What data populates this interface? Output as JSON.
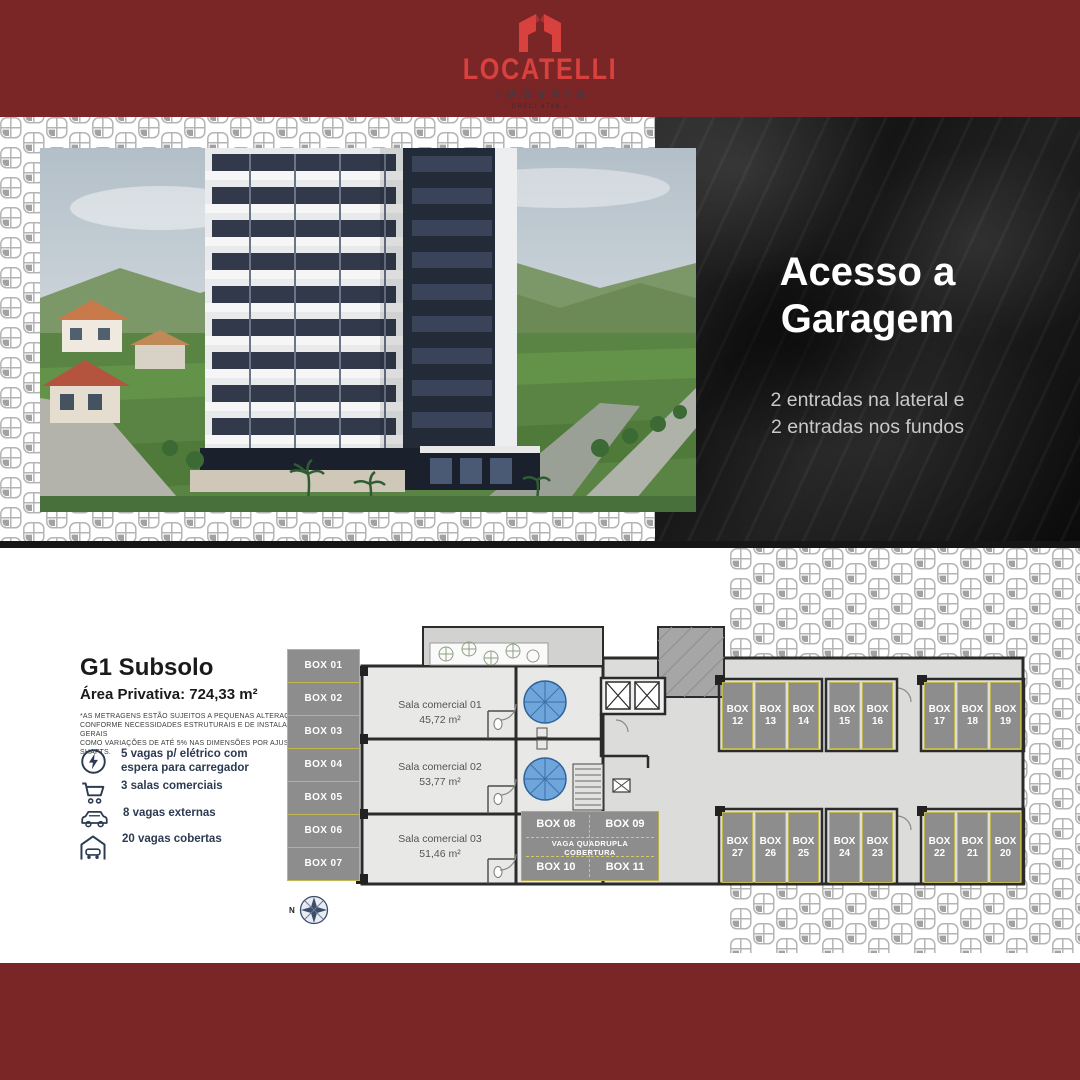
{
  "brand": {
    "name": "LOCATELLI",
    "subtitle": "IMÓVEIS",
    "creci": "CRECI 4748-J"
  },
  "garage_panel": {
    "title_line1": "Acesso a",
    "title_line2": "Garagem",
    "subtitle_line1": "2 entradas na lateral e",
    "subtitle_line2": "2 entradas nos fundos"
  },
  "unit_info": {
    "title": "G1 Subsolo",
    "area_label": "Área Privativa: 724,33 m²",
    "disclaimer_line1": "*AS METRAGENS ESTÃO SUJEITOS A PEQUENAS ALTERAÇÕES",
    "disclaimer_line2": "CONFORME NECESSIDADES ESTRUTURAIS E DE INSTALAÇÕES GERAIS",
    "disclaimer_line3": "COMO VARIAÇÕES DE ATÉ 5% NAS DIMENSÕES POR AJUSTES E SHAFTS.",
    "features": [
      {
        "icon": "ev-charger-icon",
        "label": "5 vagas p/ elétrico com espera para carregador"
      },
      {
        "icon": "shopping-cart-icon",
        "label": "3 salas comerciais"
      },
      {
        "icon": "car-icon",
        "label": "8 vagas externas"
      },
      {
        "icon": "covered-garage-icon",
        "label": "20 vagas cobertas"
      }
    ]
  },
  "floor_plan": {
    "left_boxes": [
      "BOX 01",
      "BOX 02",
      "BOX 03",
      "BOX 04",
      "BOX 05",
      "BOX 06",
      "BOX 07"
    ],
    "rooms": [
      {
        "name": "Sala comercial 01",
        "area": "45,72 m²"
      },
      {
        "name": "Sala comercial 02",
        "area": "53,77 m²"
      },
      {
        "name": "Sala comercial 03",
        "area": "51,46 m²"
      }
    ],
    "quad_block": {
      "top_left": "BOX 08",
      "top_right": "BOX 09",
      "label_line1": "VAGA QUADRUPLA",
      "label_line2": "COBERTURA",
      "bottom_left": "BOX 10",
      "bottom_right": "BOX 11"
    },
    "top_row": [
      "BOX 12",
      "BOX 13",
      "BOX 14",
      "BOX 15",
      "BOX 16",
      "BOX 17",
      "BOX 18",
      "BOX 19"
    ],
    "bottom_row": [
      "BOX 27",
      "BOX 26",
      "BOX 25",
      "BOX 24",
      "BOX 23",
      "BOX 22",
      "BOX 21",
      "BOX 20"
    ],
    "compass_label": "N"
  },
  "colors": {
    "header_red": "#7a2626",
    "logo_red": "#d8413d",
    "logo_dark": "#33404c",
    "panel_black": "#151515",
    "box_gray": "#8d8d8d",
    "box_border_yellow": "#c2b751",
    "ramp_blue": "#6ea6dc",
    "feature_text": "#2c3a52"
  }
}
